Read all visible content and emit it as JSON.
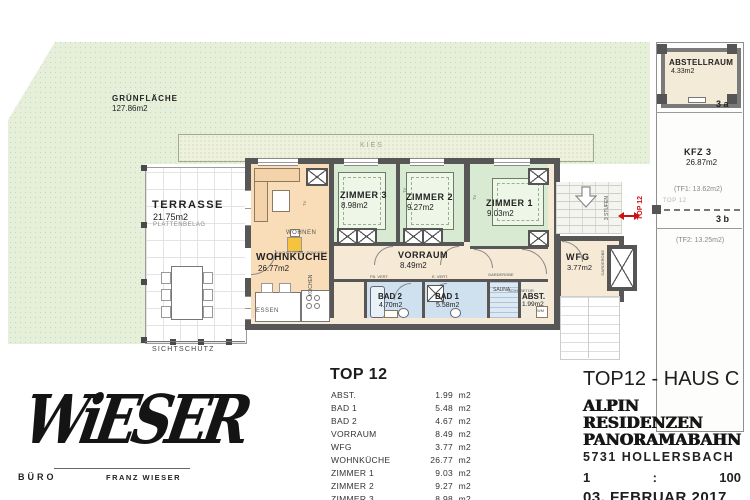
{
  "colors": {
    "wall": "#575757",
    "site_green": "#e6efda",
    "room_green": "#d9ead2",
    "room_orange": "#f9ddb9",
    "room_blue": "#cfe0ef",
    "room_beige": "#f6ead6",
    "accent_red": "#cc1111"
  },
  "plan": {
    "gruenflaeche_name": "GRÜNFLÄCHE",
    "gruenflaeche_area": "127.86m2",
    "kies": "KIES",
    "terrasse_name": "TERRASSE",
    "terrasse_area": "21.75m2",
    "terrasse_note": "PLATTENBELAG",
    "sichtschutz": "SICHTSCHUTZ",
    "wohnkueche_name": "WOHNKÜCHE",
    "wohnkueche_area": "26.77m2",
    "wohnen": "WOHNEN",
    "essen": "ESSEN",
    "kochen": "KOCHEN",
    "tv": "TV",
    "kachelofen": "KACHELOFEN / SONDERW.",
    "zimmer3_name": "ZIMMER 3",
    "zimmer3_area": "8.98m2",
    "zimmer2_name": "ZIMMER 2",
    "zimmer2_area": "9.27m2",
    "zimmer1_name": "ZIMMER 1",
    "zimmer1_area": "9.03m2",
    "vorraum_name": "VORRAUM",
    "vorraum_area": "8.49m2",
    "fb_vert": "FB. VERT.",
    "e_vert": "E. VERT.",
    "garderobe": "GARDEROBE",
    "schiebetuer": "SCHIEBETÜR",
    "bad2_name": "BAD 2",
    "bad2_area": "4.70m2",
    "bad1_name": "BAD 1",
    "bad1_area": "5.58m2",
    "sauna": "SAUNA",
    "abst_name": "ABST.",
    "abst_area": "1.99m2",
    "wm": "WM",
    "wfg_name": "WFG",
    "wfg_area": "3.77m2",
    "stufen": "3 STUFEN",
    "top12_red": "TOP 12"
  },
  "strip": {
    "abstellraum_name": "ABSTELLRAUM",
    "abstellraum_area": "4.33m2",
    "sect_a": "3 a",
    "kfz_name": "KFZ 3",
    "kfz_area": "26.87m2",
    "tf1": "(TF1: 13.62m2)",
    "top12_gray": "TOP 12",
    "sect_b": "3 b",
    "tf2": "(TF2: 13.25m2)"
  },
  "table": {
    "title": "TOP 12",
    "unit": "m2",
    "rows": [
      {
        "name": "ABST.",
        "value": "1.99"
      },
      {
        "name": "BAD 1",
        "value": "5.48"
      },
      {
        "name": "BAD 2",
        "value": "4.67"
      },
      {
        "name": "VORRAUM",
        "value": "8.49"
      },
      {
        "name": "WFG",
        "value": "3.77"
      },
      {
        "name": "WOHNKÜCHE",
        "value": "26.77"
      },
      {
        "name": "ZIMMER 1",
        "value": "9.03"
      },
      {
        "name": "ZIMMER 2",
        "value": "9.27"
      },
      {
        "name": "ZIMMER 3",
        "value": "8.98"
      }
    ],
    "total": "78.45"
  },
  "titleblock": {
    "title": "TOP12 - HAUS C",
    "project1": "ALPIN RESIDENZEN",
    "project2": "PANORAMABAHN",
    "address": "5731 HOLLERSBACH",
    "scale_left": "1",
    "scale_colon": ":",
    "scale_right": "100",
    "date": "03. FEBRUAR 2017"
  },
  "logo": {
    "wordmark": "WiESER",
    "buero": "BÜRO",
    "name": "FRANZ WIESER"
  }
}
